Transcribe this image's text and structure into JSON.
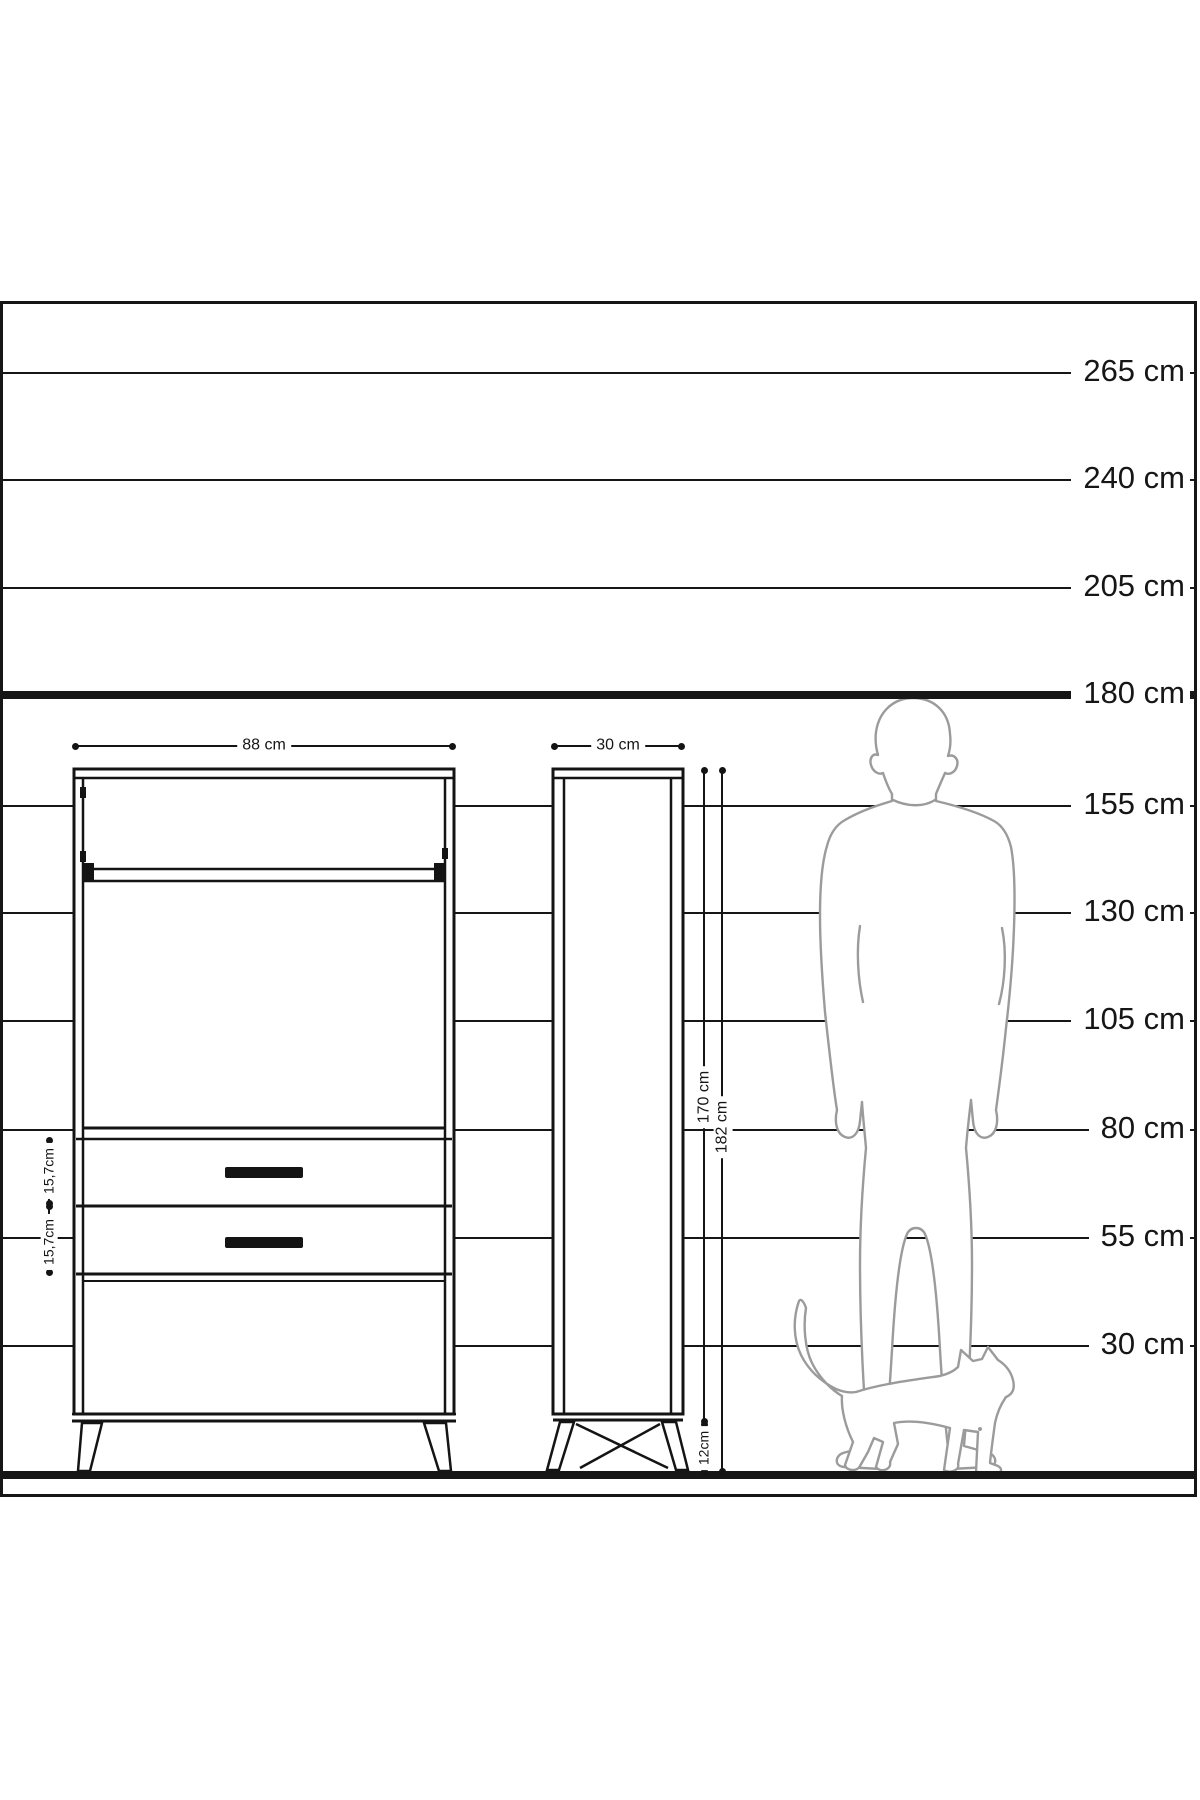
{
  "colors": {
    "ink": "#161616",
    "silhouette": "#9b9b9b",
    "background": "#ffffff"
  },
  "scale_ruler": {
    "unit": "cm",
    "values_cm": [
      265,
      240,
      205,
      180,
      155,
      130,
      105,
      80,
      55,
      30
    ],
    "labels": [
      "265 cm",
      "240 cm",
      "205 cm",
      "180 cm",
      "155 cm",
      "130 cm",
      "105 cm",
      "80 cm",
      "55 cm",
      "30 cm"
    ],
    "bold_lines": [
      "180 cm",
      "floor"
    ]
  },
  "furniture": {
    "front_view": {
      "width_label": "88 cm",
      "upper_drawer_height_label": "15,7cm",
      "lower_drawer_height_label": "15,7cm"
    },
    "side_view": {
      "depth_label": "30 cm",
      "carcass_height_label": "170 cm",
      "total_height_label": "182 cm",
      "leg_height_label": "12cm"
    }
  },
  "silhouettes": {
    "person": "person-silhouette",
    "cat": "cat-silhouette"
  }
}
